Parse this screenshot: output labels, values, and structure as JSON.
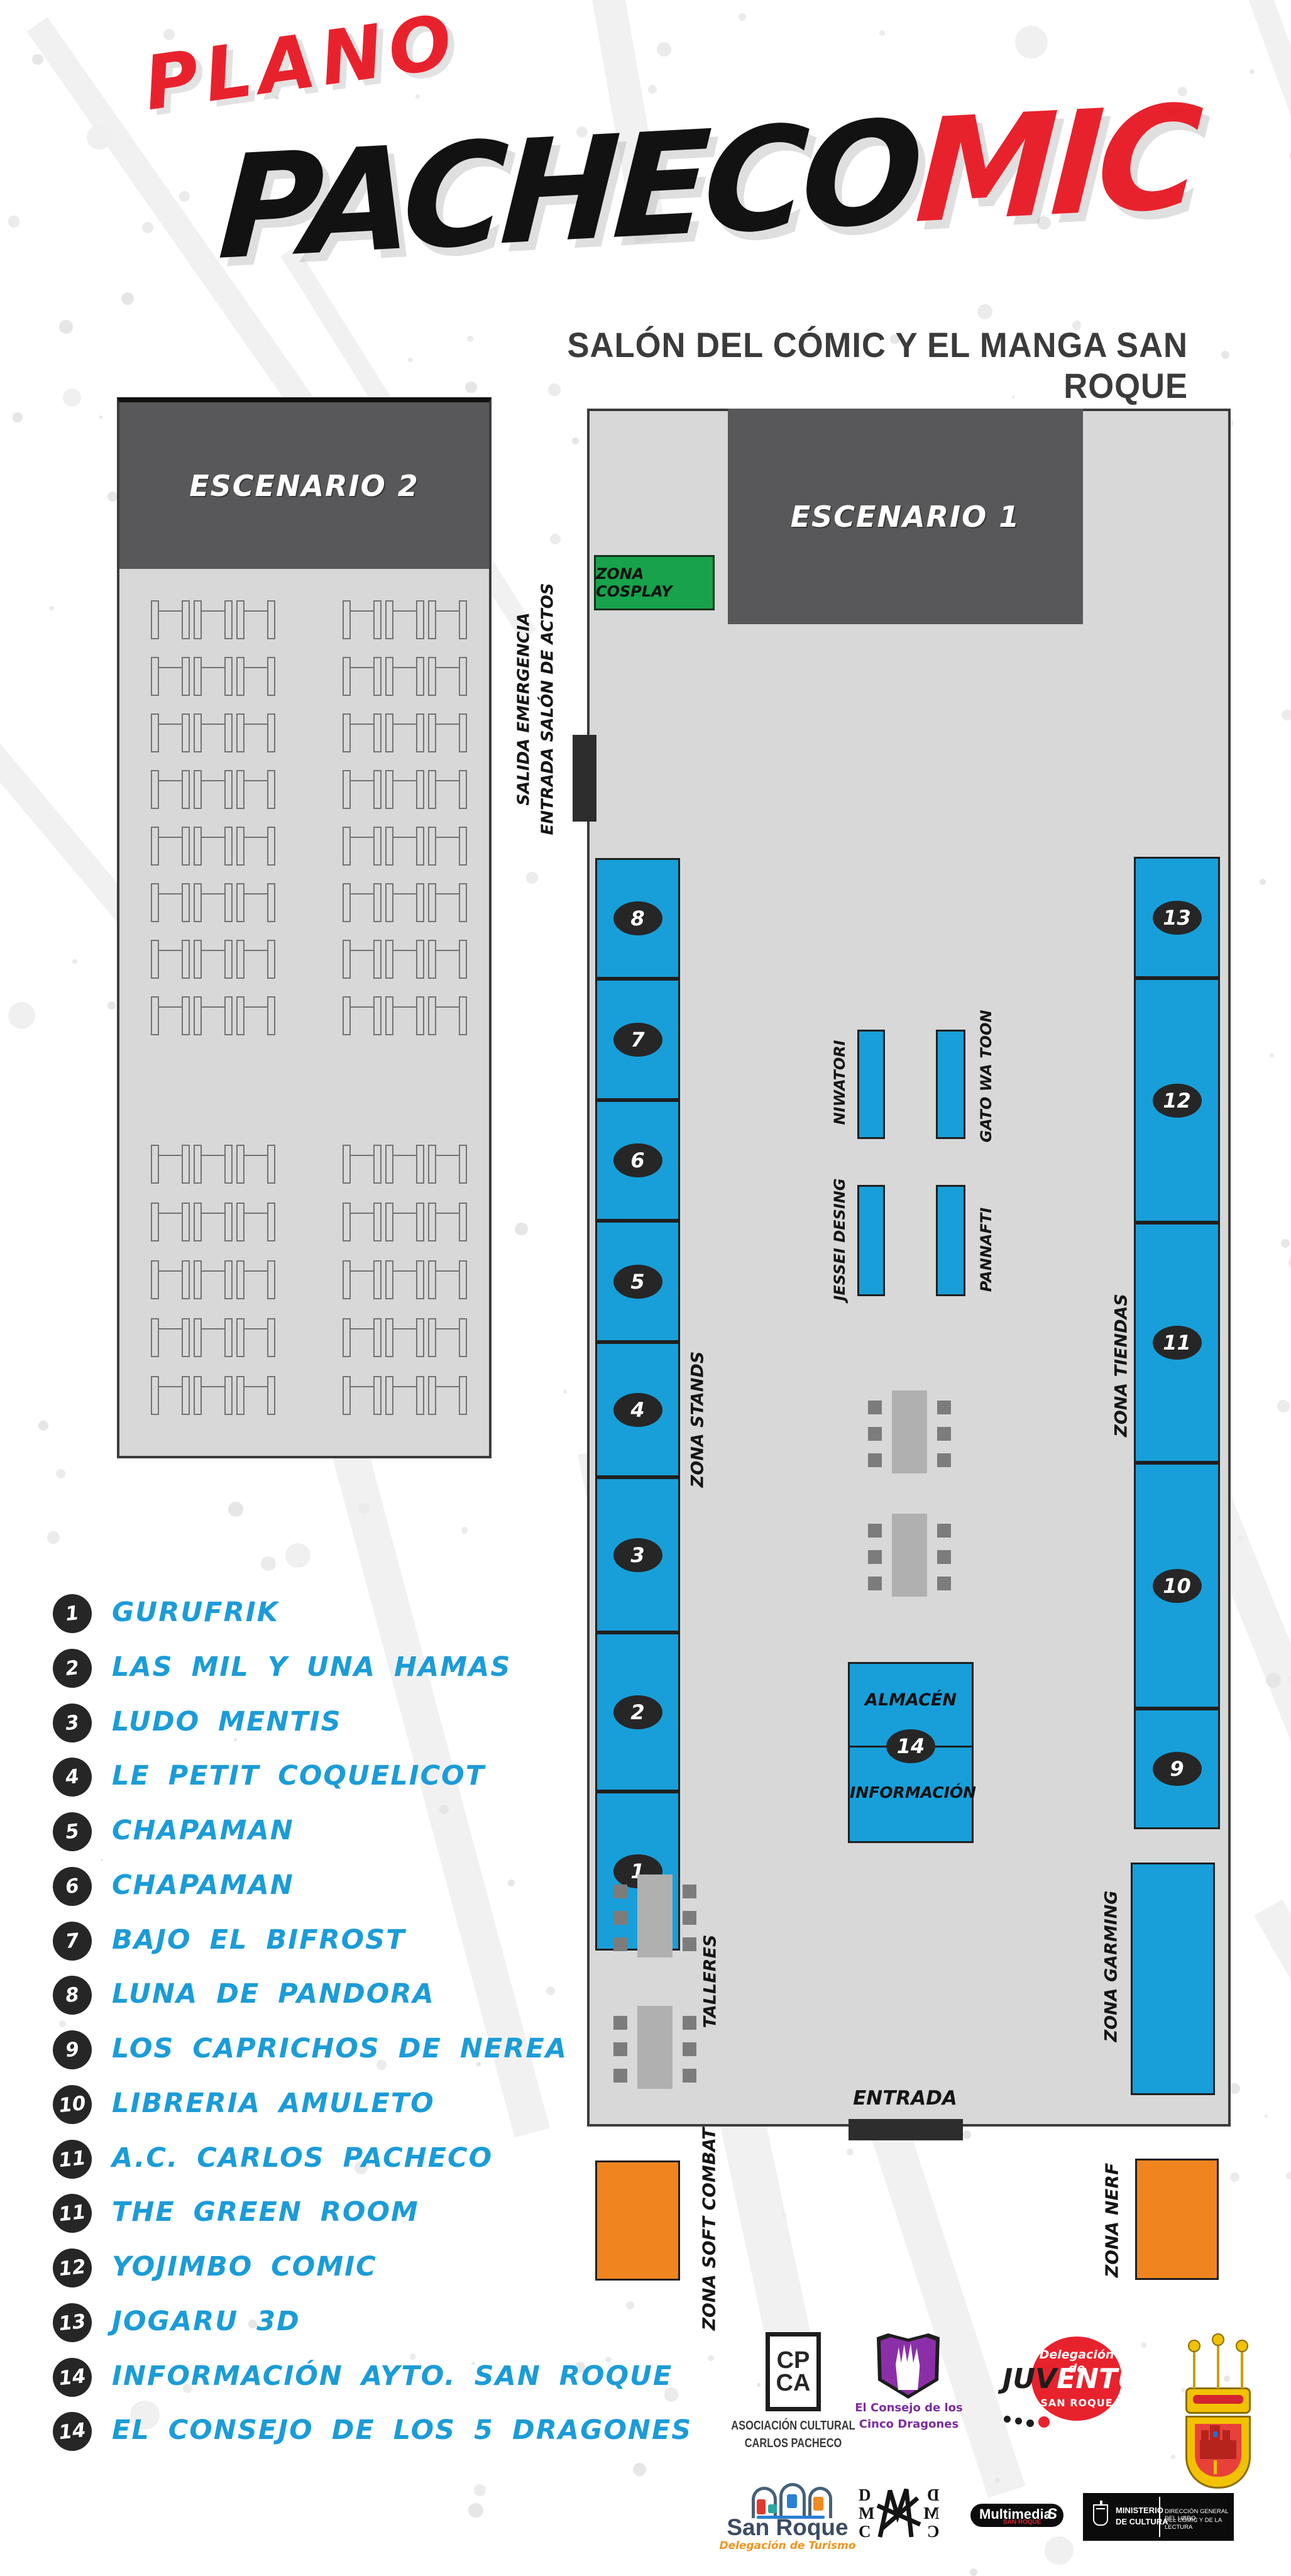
{
  "title": {
    "kicker": "PLANO",
    "brand_black": "PACHECO",
    "brand_red": "MIC",
    "subtitle": "SALÓN DEL CÓMIC Y EL MANGA SAN ROQUE"
  },
  "map": {
    "hall2": {
      "stage": "ESCENARIO 2"
    },
    "hall1": {
      "stage": "ESCENARIO 1",
      "cosplay": "ZONA COSPLAY",
      "exit_line1": "SALIDA EMERGENCIA",
      "exit_line2": "ENTRADA SALÓN DE ACTOS",
      "zona_stands": "ZONA STANDS",
      "zona_tiendas": "ZONA TIENDAS",
      "zona_garming": "ZONA GARMING",
      "talleres": "TALLERES",
      "almacen": "ALMACÉN",
      "info": "INFORMACIÓN",
      "info_number": "14",
      "entrada": "ENTRADA"
    },
    "left_stands": [
      "8",
      "7",
      "6",
      "5",
      "4",
      "3",
      "2",
      "1"
    ],
    "right_stands": [
      "13",
      "12",
      "11",
      "10",
      "9"
    ],
    "mini_stands": [
      "NIWATORI",
      "GATO WA TOON",
      "JESSEI DESING",
      "PANNAFTI"
    ],
    "outdoor": {
      "soft_combat": "ZONA SOFT COMBAT",
      "nerf": "ZONA NERF"
    }
  },
  "legend": [
    {
      "num": "1",
      "label": "GURUFRIK"
    },
    {
      "num": "2",
      "label": "LAS MIL Y UNA HAMAS"
    },
    {
      "num": "3",
      "label": "LUDO MENTIS"
    },
    {
      "num": "4",
      "label": "LE PETIT COQUELICOT"
    },
    {
      "num": "5",
      "label": "CHAPAMAN"
    },
    {
      "num": "6",
      "label": "CHAPAMAN"
    },
    {
      "num": "7",
      "label": "BAJO EL BIFROST"
    },
    {
      "num": "8",
      "label": "LUNA DE PANDORA"
    },
    {
      "num": "9",
      "label": "LOS CAPRICHOS DE NEREA"
    },
    {
      "num": "10",
      "label": "LIBRERIA AMULETO"
    },
    {
      "num": "11",
      "label": "A.C. CARLOS PACHECO"
    },
    {
      "num": "11",
      "label": "THE GREEN ROOM"
    },
    {
      "num": "12",
      "label": "YOJIMBO COMIC"
    },
    {
      "num": "13",
      "label": "JOGARU 3D"
    },
    {
      "num": "14",
      "label": "INFORMACIÓN AYTO. SAN ROQUE"
    },
    {
      "num": "14",
      "label": "EL CONSEJO DE LOS 5 DRAGONES"
    }
  ],
  "sponsors": {
    "cpca": {
      "line1": "CP",
      "line2": "CA",
      "caption1": "ASOCIACIÓN CULTURAL",
      "caption2": "CARLOS PACHECO"
    },
    "dragones": {
      "caption1": "El Consejo de los",
      "caption2": "Cinco Dragones"
    },
    "juventud": {
      "top": "Delegación de",
      "black": "JUV",
      "white": "ENTUD",
      "bottom": "SAN ROQUE"
    },
    "turismo": {
      "name": "San Roque",
      "caption": "Delegación de Turismo"
    },
    "dmc": {
      "l1": "D",
      "l2": "M",
      "l3": "C"
    },
    "multimedia": {
      "name": "Multimedia",
      "sub": "SAN ROQUE",
      "swoosh": "S"
    },
    "ministerio": {
      "line1": "MINISTERIO",
      "line2": "DE CULTURA",
      "right1": "DIRECCIÓN GENERAL DEL LIBRO,",
      "right2": "DEL CÓMIC Y DE LA LECTURA"
    }
  },
  "colors": {
    "blue": "#189fd9",
    "green": "#17a24b",
    "orange": "#f0851f",
    "dark_gray": "#58585a",
    "hall_gray": "#d7d8d7",
    "red": "#e8222d",
    "legend_blue": "#1b9cd8"
  }
}
